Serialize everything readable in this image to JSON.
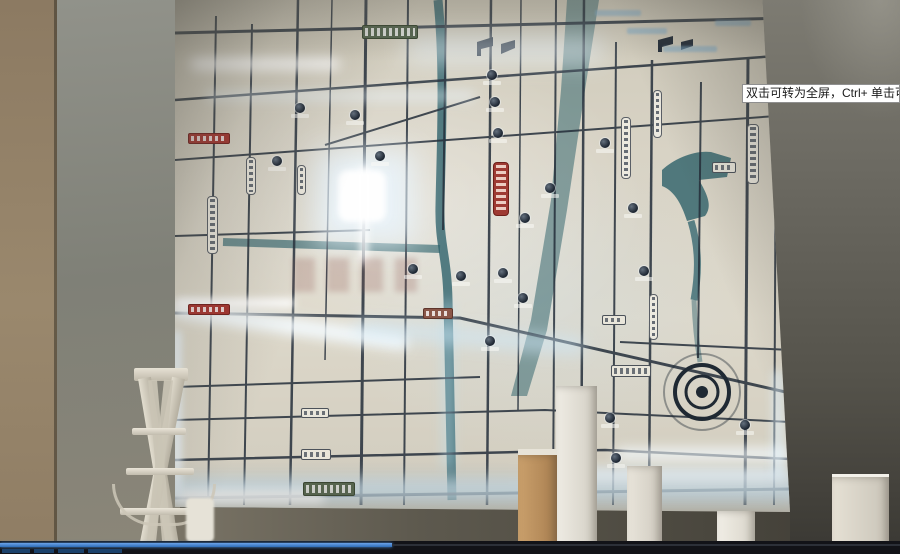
{
  "video_overlay": {
    "tooltip_text": "双击可转为全屏，Ctrl+ 单击可转为",
    "progress_fraction": 0.435
  },
  "colors": {
    "accent_blue": "#3f86d8",
    "map_glow": "#dff2ff",
    "river_teal": "#336a74",
    "sign_red": "#a63530",
    "sign_green": "#55664f",
    "wall_grey": "#83847a",
    "wall_tan": "#94826a"
  },
  "icons": {
    "poi_marker": "filled-circle-badge",
    "flag_marker": "bent-flag",
    "roundabout": "concentric-circles",
    "river": "teal-band",
    "road": "dark-grid-line"
  }
}
